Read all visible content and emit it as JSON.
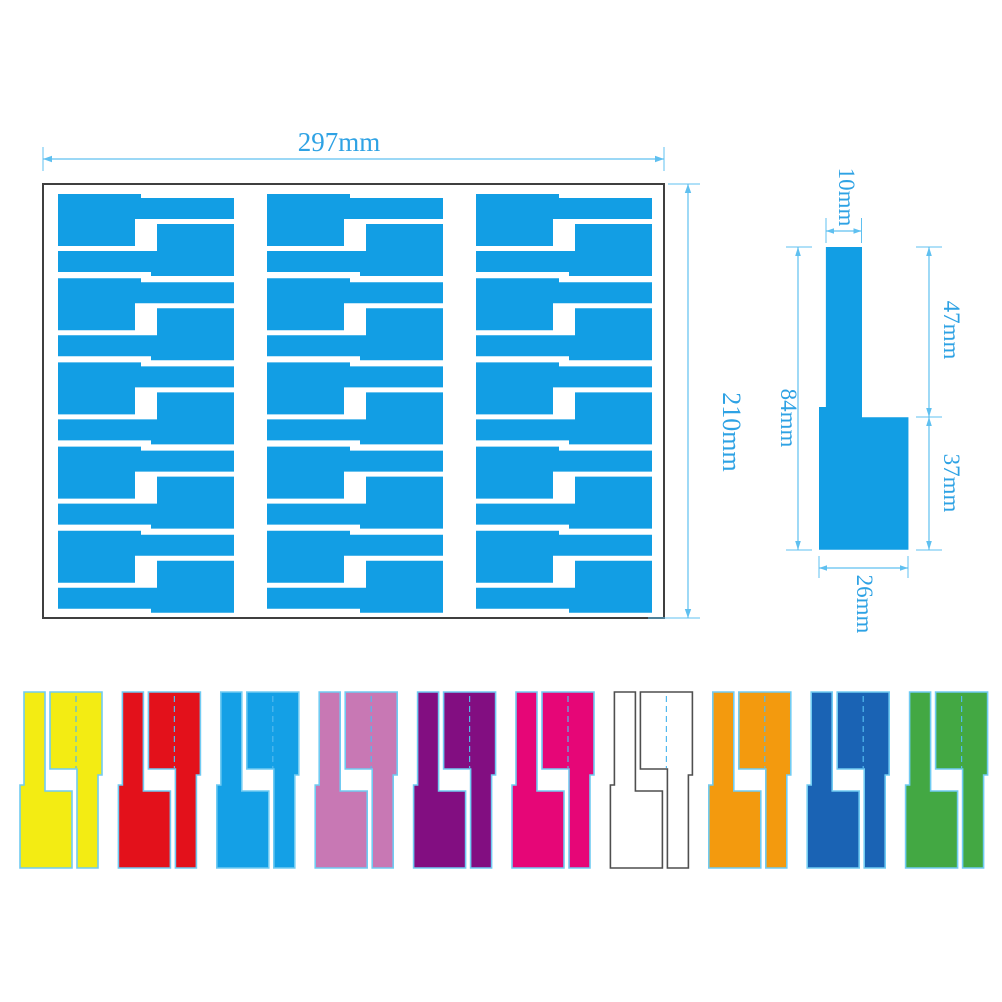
{
  "colors": {
    "label_blue": "#129EE4",
    "dim_line": "#5FC0F0",
    "dim_text": "#2EA2E4",
    "sheet_border": "#3F3F3F",
    "fold_dash": "#53B9EE"
  },
  "sheet": {
    "width_label": "297mm",
    "height_label": "210mm",
    "rows": 5,
    "cols": 3
  },
  "label_detail": {
    "stem_width_label": "10mm",
    "stem_length_label": "47mm",
    "total_length_label": "84mm",
    "flag_length_label": "37mm",
    "flag_width_label": "26mm"
  },
  "color_variants": [
    {
      "name": "yellow",
      "fill": "#F3EC13",
      "stroke": "#70CBF2"
    },
    {
      "name": "red",
      "fill": "#E3111B",
      "stroke": "#70CBF2"
    },
    {
      "name": "sky-blue",
      "fill": "#14A0E6",
      "stroke": "#70CBF2"
    },
    {
      "name": "orchid-pink",
      "fill": "#C878B4",
      "stroke": "#70CBF2"
    },
    {
      "name": "purple",
      "fill": "#820E81",
      "stroke": "#70CBF2"
    },
    {
      "name": "rose-magenta",
      "fill": "#E60677",
      "stroke": "#70CBF2"
    },
    {
      "name": "white",
      "fill": "#FFFFFF",
      "stroke": "#4F4F4F"
    },
    {
      "name": "orange",
      "fill": "#F39A0E",
      "stroke": "#70CBF2"
    },
    {
      "name": "royal-blue",
      "fill": "#1A63B4",
      "stroke": "#70CBF2"
    },
    {
      "name": "green",
      "fill": "#43A843",
      "stroke": "#70CBF2"
    }
  ]
}
